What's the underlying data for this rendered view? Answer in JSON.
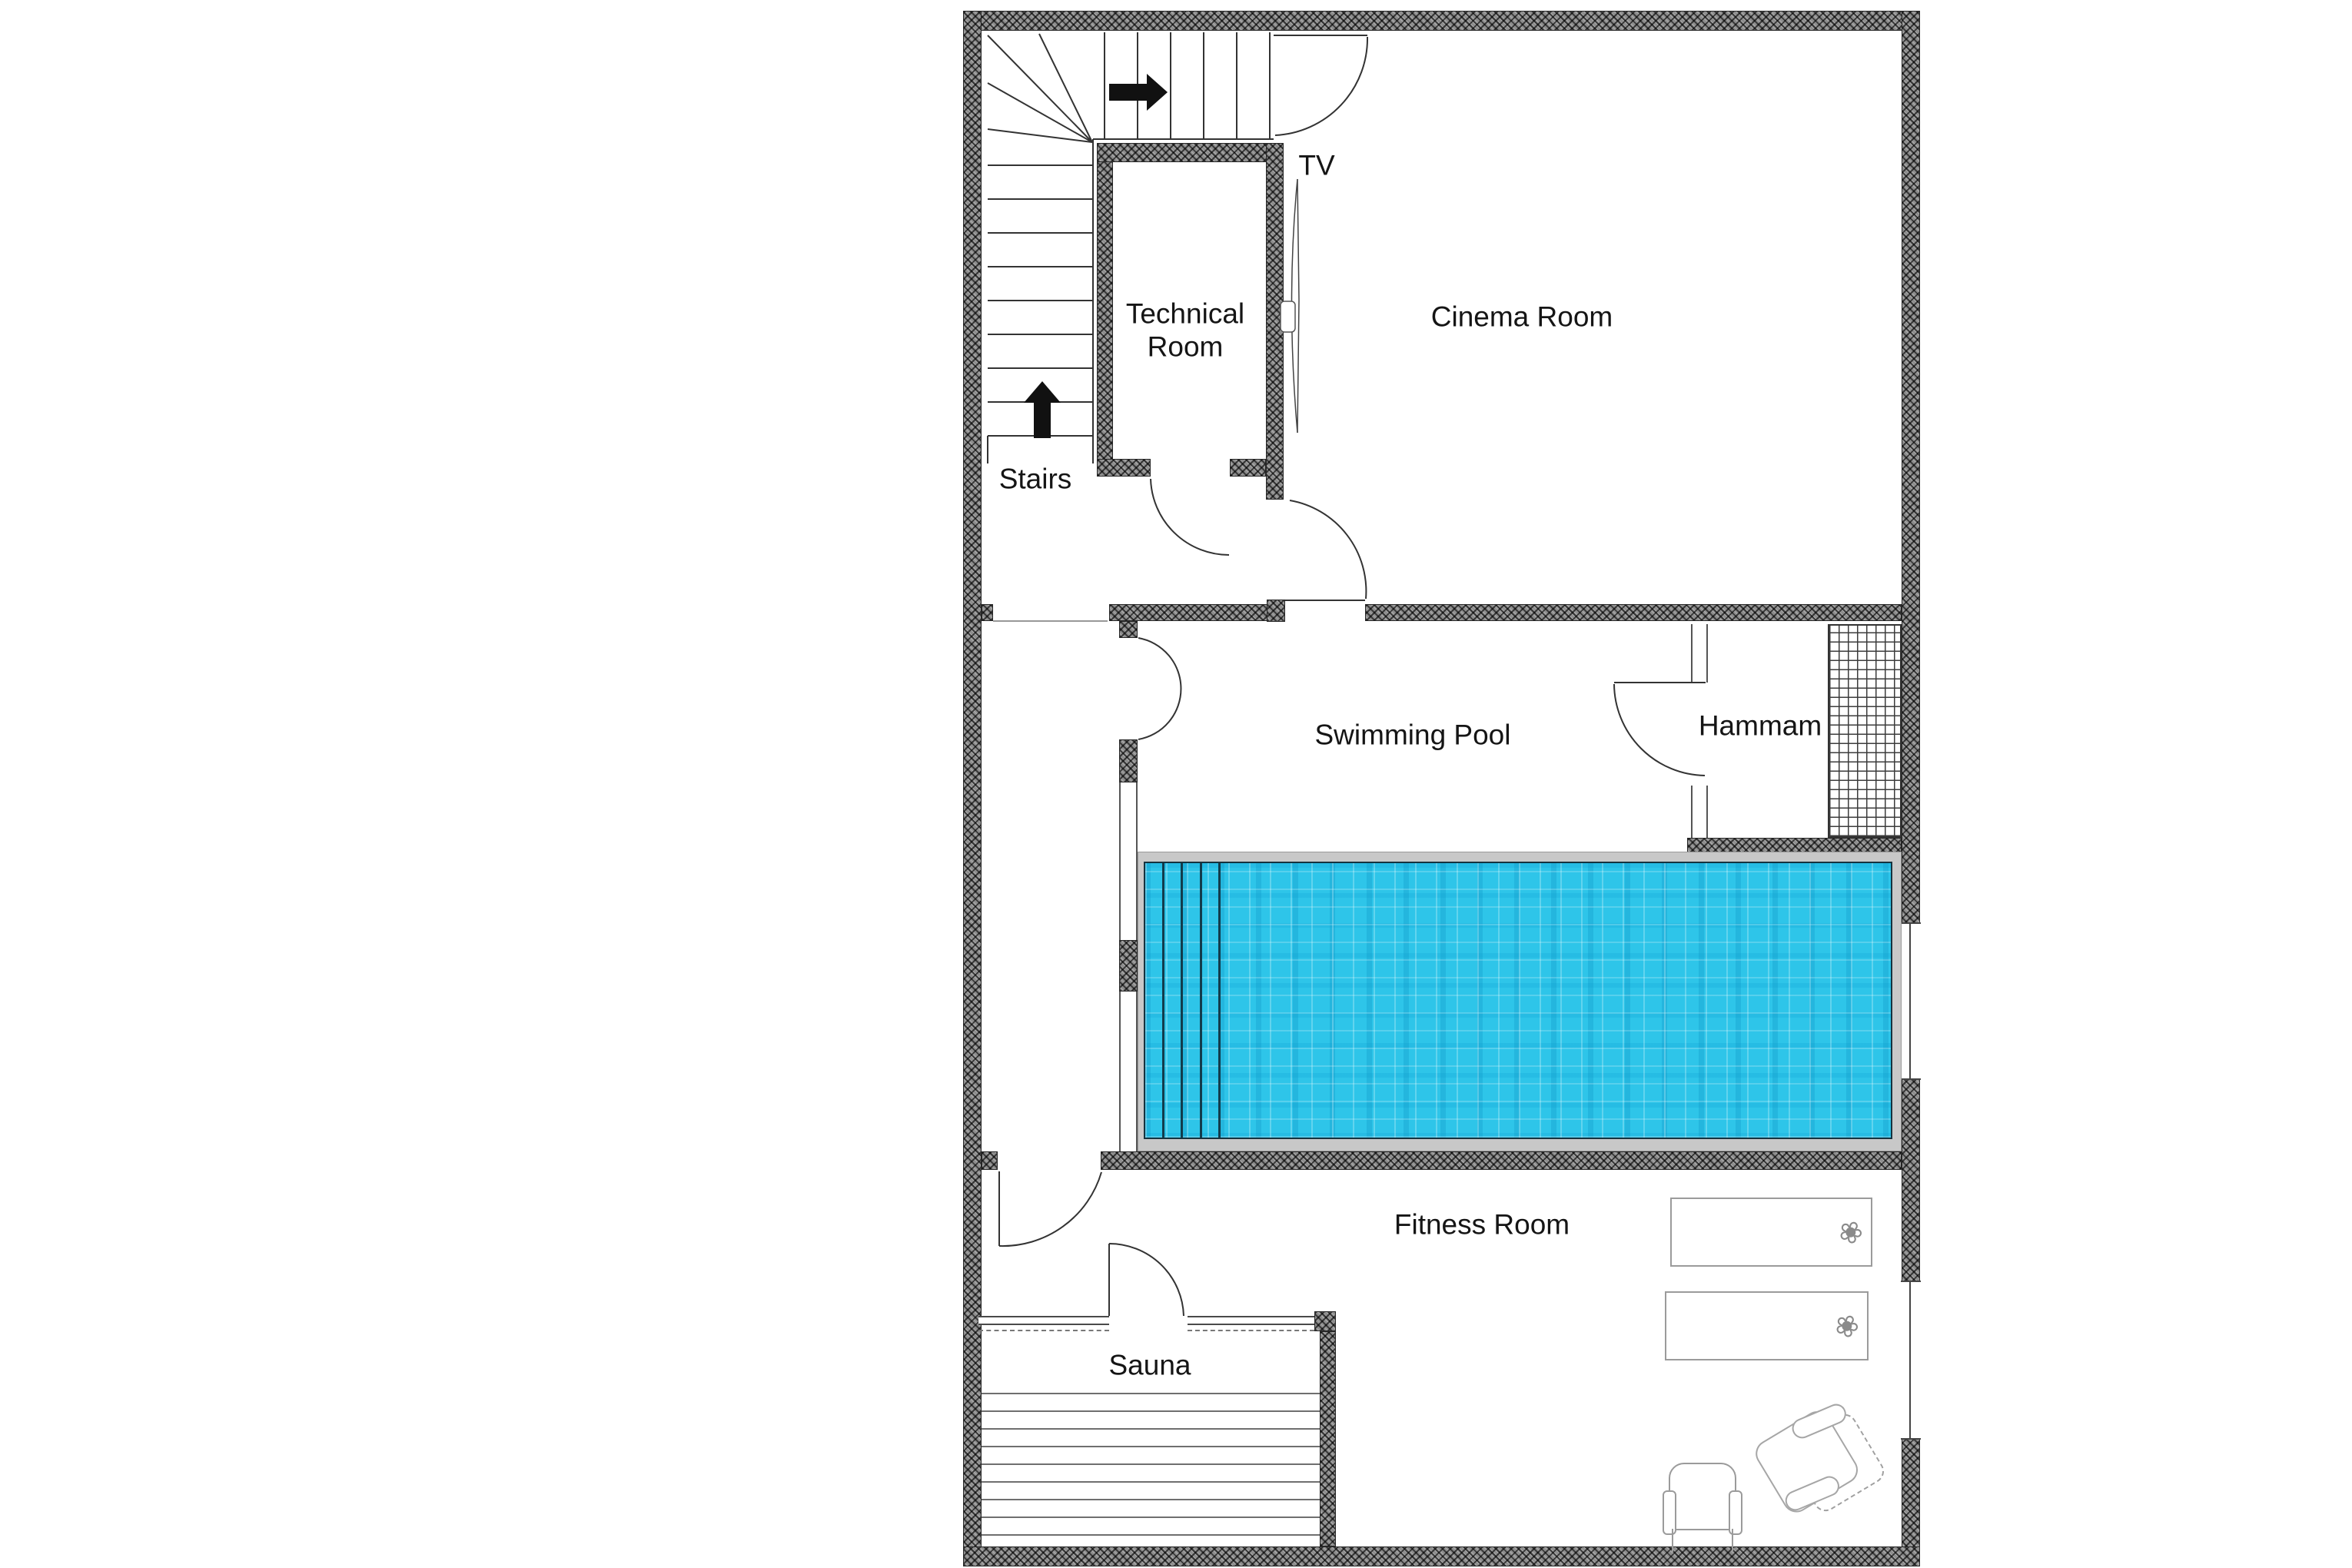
{
  "floorplan": {
    "title": "Basement floor plan",
    "rooms": [
      {
        "id": "stairs",
        "label": "Stairs"
      },
      {
        "id": "technical-room",
        "label": "Technical Room"
      },
      {
        "id": "cinema-room",
        "label": "Cinema Room"
      },
      {
        "id": "swimming-pool",
        "label": "Swimming Pool"
      },
      {
        "id": "hammam",
        "label": "Hammam"
      },
      {
        "id": "fitness-room",
        "label": "Fitness Room"
      },
      {
        "id": "sauna",
        "label": "Sauna"
      }
    ],
    "annotations": [
      {
        "id": "tv",
        "label": "TV"
      }
    ],
    "icons": {
      "flower": "❀"
    },
    "colors": {
      "wall": "#8d8d8d",
      "pool_water": "#2ec5e9",
      "pool_step_line": "#123c4c",
      "deck": "#c8c8c8",
      "drawing_line": "#333333"
    }
  }
}
